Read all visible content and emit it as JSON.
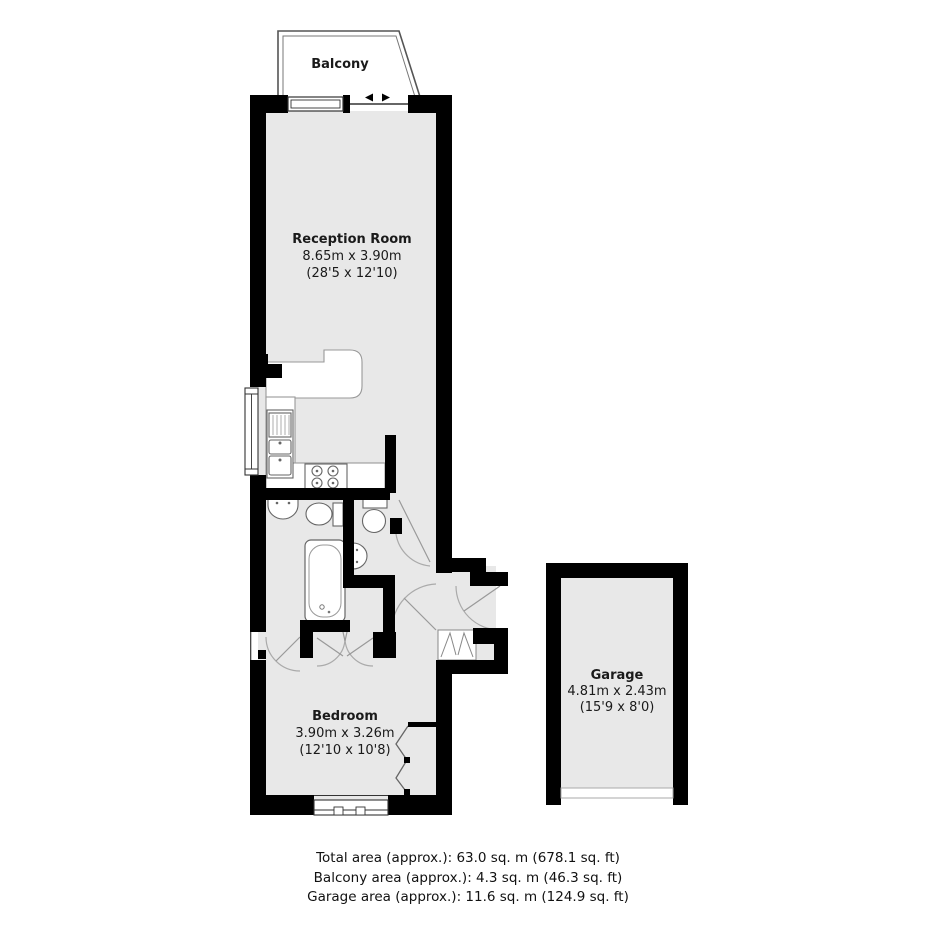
{
  "balcony": {
    "label": "Balcony"
  },
  "rooms": {
    "reception": {
      "name": "Reception Room",
      "size_metric": "8.65m x 3.90m",
      "size_imperial": "(28'5 x 12'10)"
    },
    "bedroom": {
      "name": "Bedroom",
      "size_metric": "3.90m x 3.26m",
      "size_imperial": "(12'10 x 10'8)"
    },
    "garage": {
      "name": "Garage",
      "size_metric": "4.81m x 2.43m",
      "size_imperial": "(15'9 x 8'0)"
    }
  },
  "summary_lines": [
    "Total area (approx.): 63.0 sq. m (678.1 sq. ft)",
    "Balcony area (approx.): 4.3 sq. m (46.3 sq. ft)",
    "Garage area (approx.): 11.6 sq. m (124.9 sq. ft)"
  ],
  "colors": {
    "wall": "#000000",
    "floor": "#e8e8e8",
    "fixture_outline": "#5a5a5a",
    "counter_outline": "#999999",
    "door_arc": "#aaaaaa"
  }
}
